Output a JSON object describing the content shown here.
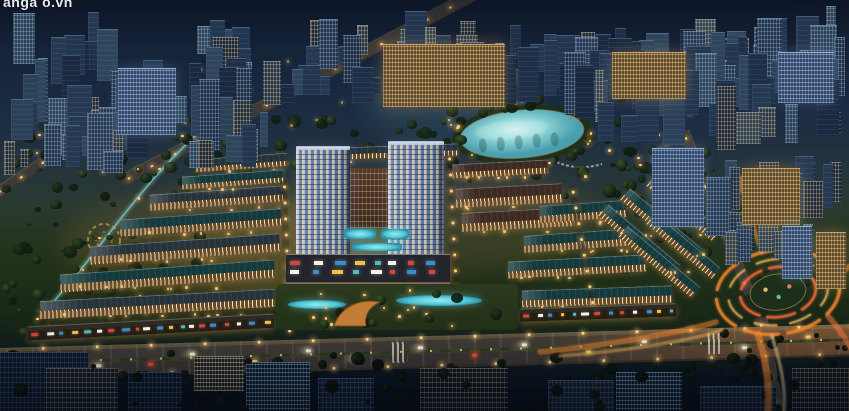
{
  "meta": {
    "width": 849,
    "height": 411,
    "description": "Night-time aerial 3D render of a mixed-use real-estate masterplan: twin residential towers on a retail podium with rooftop pools, fanned rows of lit shophouses, a glowing lagoon lake ringed by palms, landscaped parks, a main boulevard with traffic, and a light-trail roundabout, all surrounded by a dense city."
  },
  "watermark": {
    "text": "anga o.vn"
  },
  "palette": {
    "bldg": [
      "#1e2f47",
      "#253a52",
      "#2b4158",
      "#1a2940",
      "#223650",
      "#2e455c"
    ],
    "window_warm": "#ffcf7e",
    "window_cool": "#cfe2f2",
    "tree": [
      "#15240f",
      "#22351a",
      "#2f4520",
      "#3d5526"
    ],
    "tree_dark": [
      "#0a130c",
      "#0e1910",
      "#132015"
    ],
    "light_warm": "#ffd88f",
    "roof_teal": "#16393c",
    "roof_teal_l": "#1f4b4e",
    "roof_maroon": "#3c2a25",
    "roof_maroon_l": "#52362c",
    "roof_slate": "#26333b",
    "roof_slate_l": "#33434c",
    "lake_core": "#cfeeec",
    "lake_mid": "#8fd7d8",
    "lake_edge": "#4a9fae",
    "stream": "#58bfc2",
    "garden_ring": "#d8b36a",
    "trail": "#ff8c2e",
    "trail_soft": "#ffc05e",
    "trail_hot": "#ff6a3a",
    "pool": "#4ec6d6",
    "pool_light": "#9fe8ee",
    "feature": "#c27c38",
    "feature_dark": "#7e4c1e",
    "sign": [
      "#e33f35",
      "#f5f2ea",
      "#2f8fd8",
      "#f2c23e",
      "#44c1b7",
      "#f5f2ea",
      "#e33f35",
      "#2f8fd8"
    ],
    "fg": [
      "#0e1a2a",
      "#101d2e",
      "#0c1726",
      "#13202f"
    ]
  },
  "glows": [
    {
      "x": 220,
      "y": 245,
      "w": 320,
      "h": 110,
      "c": "rgba(255,170,80,0.10)"
    },
    {
      "x": 430,
      "y": 220,
      "w": 330,
      "h": 110,
      "c": "rgba(255,170,80,0.09)"
    },
    {
      "x": 300,
      "y": 255,
      "w": 260,
      "h": 90,
      "c": "rgba(255,190,100,0.12)"
    },
    {
      "x": 450,
      "y": 100,
      "w": 180,
      "h": 80,
      "c": "rgba(120,220,220,0.10)"
    }
  ],
  "city_regions": [
    {
      "x": 0,
      "y": 0,
      "w": 849,
      "h": 105,
      "count": 95,
      "minH": 14,
      "maxH": 55,
      "lit": 0.45
    },
    {
      "x": 0,
      "y": 55,
      "w": 270,
      "h": 115,
      "count": 34,
      "minH": 22,
      "maxH": 70,
      "lit": 0.5
    },
    {
      "x": 540,
      "y": 0,
      "w": 309,
      "h": 150,
      "count": 44,
      "minH": 18,
      "maxH": 65,
      "lit": 0.5
    },
    {
      "x": 700,
      "y": 120,
      "w": 149,
      "h": 160,
      "count": 24,
      "minH": 20,
      "maxH": 60,
      "lit": 0.55
    },
    {
      "x": 0,
      "y": 85,
      "w": 130,
      "h": 95,
      "count": 14,
      "minH": 16,
      "maxH": 45,
      "lit": 0.5
    }
  ],
  "landmarks": [
    {
      "x": 383,
      "y": 44,
      "w": 122,
      "h": 62,
      "kind": "warm"
    },
    {
      "x": 612,
      "y": 52,
      "w": 74,
      "h": 46,
      "kind": "warm"
    },
    {
      "x": 118,
      "y": 68,
      "w": 58,
      "h": 66,
      "kind": "cool"
    },
    {
      "x": 778,
      "y": 52,
      "w": 56,
      "h": 50,
      "kind": "cool"
    },
    {
      "x": 652,
      "y": 148,
      "w": 52,
      "h": 78,
      "kind": "cool"
    },
    {
      "x": 742,
      "y": 168,
      "w": 58,
      "h": 56,
      "kind": "warm"
    },
    {
      "x": 782,
      "y": 226,
      "w": 30,
      "h": 52,
      "kind": "cool"
    },
    {
      "x": 816,
      "y": 232,
      "w": 30,
      "h": 56,
      "kind": "warm"
    }
  ],
  "roads": {
    "boulevard": {
      "x": -20,
      "y": 336,
      "w": 900,
      "h": 28,
      "rot": -1.6
    },
    "diagonals": [
      {
        "cx": 312,
        "cy": 80,
        "len": 430,
        "wd": 13,
        "rot": -28
      },
      {
        "cx": 72,
        "cy": 142,
        "len": 190,
        "wd": 11,
        "rot": -34
      },
      {
        "cx": 716,
        "cy": 212,
        "len": 175,
        "wd": 11,
        "rot": 68
      },
      {
        "cx": 770,
        "cy": 372,
        "len": 110,
        "wd": 14,
        "rot": 80
      }
    ],
    "inner_streets": [
      {
        "cx": 286,
        "cy": 255,
        "len": 150,
        "wd": 7,
        "rot": 88
      },
      {
        "cx": 452,
        "cy": 222,
        "len": 140,
        "wd": 7,
        "rot": 87
      },
      {
        "cx": 582,
        "cy": 245,
        "len": 120,
        "wd": 6,
        "rot": 80
      }
    ],
    "crosswalks": [
      {
        "x": 392
      },
      {
        "x": 708
      }
    ],
    "streetlight_step": 54
  },
  "cars": [
    {
      "x": 58,
      "lane": -1,
      "c": "w"
    },
    {
      "x": 96,
      "lane": 1,
      "c": "w"
    },
    {
      "x": 148,
      "lane": 1,
      "c": "r"
    },
    {
      "x": 190,
      "lane": -1,
      "c": "w"
    },
    {
      "x": 252,
      "lane": 1,
      "c": "y"
    },
    {
      "x": 306,
      "lane": -1,
      "c": "w"
    },
    {
      "x": 352,
      "lane": 1,
      "c": "w"
    },
    {
      "x": 418,
      "lane": -1,
      "c": "w"
    },
    {
      "x": 472,
      "lane": 1,
      "c": "r"
    },
    {
      "x": 522,
      "lane": -1,
      "c": "w"
    },
    {
      "x": 586,
      "lane": 1,
      "c": "y"
    },
    {
      "x": 642,
      "lane": -1,
      "c": "w"
    },
    {
      "x": 742,
      "lane": 1,
      "c": "w"
    },
    {
      "x": 806,
      "lane": -1,
      "c": "y"
    }
  ],
  "lake": {
    "cx": 522,
    "cy": 134,
    "rx": 62,
    "ry": 24,
    "rot": -5,
    "palms": 18,
    "rim_lights": 8
  },
  "stream_path": "M 218,116 C 170,155 135,200 100,245 C 80,272 55,300 36,322",
  "pergola_path": "M 552,160 Q 576,172 602,164",
  "garden": {
    "cx": 104,
    "cy": 240,
    "r1": 16,
    "r2": 8
  },
  "rows": [
    {
      "x": 150,
      "y": 190,
      "w": 135,
      "h": 15,
      "rot": -4,
      "roof": "slate"
    },
    {
      "x": 120,
      "y": 214,
      "w": 162,
      "h": 16,
      "rot": -4,
      "roof": "teal"
    },
    {
      "x": 90,
      "y": 240,
      "w": 190,
      "h": 17,
      "rot": -4,
      "roof": "slate"
    },
    {
      "x": 60,
      "y": 267,
      "w": 215,
      "h": 17,
      "rot": -4,
      "roof": "teal"
    },
    {
      "x": 40,
      "y": 295,
      "w": 235,
      "h": 17,
      "rot": -3,
      "roof": "slate"
    },
    {
      "x": 28,
      "y": 320,
      "w": 246,
      "h": 13,
      "rot": -3,
      "roof": "slate",
      "retail": true
    },
    {
      "x": 196,
      "y": 156,
      "w": 92,
      "h": 12,
      "rot": -4,
      "roof": "slate"
    },
    {
      "x": 182,
      "y": 173,
      "w": 102,
      "h": 12,
      "rot": -4,
      "roof": "teal"
    },
    {
      "x": 308,
      "y": 146,
      "w": 150,
      "h": 11,
      "rot": -2,
      "roof": "slate"
    },
    {
      "x": 452,
      "y": 162,
      "w": 96,
      "h": 13,
      "rot": -3,
      "roof": "maroon"
    },
    {
      "x": 456,
      "y": 186,
      "w": 106,
      "h": 18,
      "rot": -3,
      "roof": "maroon"
    },
    {
      "x": 462,
      "y": 210,
      "w": 112,
      "h": 18,
      "rot": -3,
      "roof": "maroon"
    },
    {
      "x": 540,
      "y": 203,
      "w": 86,
      "h": 16,
      "rot": -4,
      "roof": "teal"
    },
    {
      "x": 524,
      "y": 232,
      "w": 112,
      "h": 16,
      "rot": -4,
      "roof": "teal"
    },
    {
      "x": 508,
      "y": 258,
      "w": 138,
      "h": 16,
      "rot": -3,
      "roof": "teal"
    },
    {
      "x": 522,
      "y": 288,
      "w": 150,
      "h": 16,
      "rot": -2,
      "roof": "teal"
    },
    {
      "x": 520,
      "y": 306,
      "w": 156,
      "h": 12,
      "rot": -2,
      "roof": "slate",
      "retail": true
    },
    {
      "x": 592,
      "y": 233,
      "w": 95,
      "h": 14,
      "rot": 40,
      "roof": "teal"
    },
    {
      "x": 614,
      "y": 217,
      "w": 95,
      "h": 14,
      "rot": 40,
      "roof": "teal"
    },
    {
      "x": 641,
      "y": 201,
      "w": 85,
      "h": 13,
      "rot": 40,
      "roof": "teal"
    },
    {
      "x": 612,
      "y": 255,
      "w": 95,
      "h": 13,
      "rot": 40,
      "roof": "teal"
    },
    {
      "x": 641,
      "y": 239,
      "w": 85,
      "h": 13,
      "rot": 40,
      "roof": "teal"
    }
  ],
  "dev": {
    "towers": [
      {
        "x": 296,
        "y": 147,
        "w": 54,
        "h": 112
      },
      {
        "x": 388,
        "y": 142,
        "w": 56,
        "h": 117
      }
    ],
    "courtyard": {
      "x": 326,
      "y": 168,
      "w": 88,
      "h": 58
    },
    "pools": [
      {
        "x": 344,
        "y": 229,
        "w": 32,
        "h": 10
      },
      {
        "x": 381,
        "y": 229,
        "w": 28,
        "h": 10
      },
      {
        "x": 352,
        "y": 243,
        "w": 50,
        "h": 8
      }
    ],
    "podium": {
      "x": 286,
      "y": 254,
      "w": 164,
      "h": 32
    },
    "amenity": {
      "x": 276,
      "y": 284,
      "w": 242,
      "h": 46
    },
    "ponds": [
      {
        "x": 288,
        "y": 300,
        "w": 58,
        "h": 9
      },
      {
        "x": 396,
        "y": 295,
        "w": 86,
        "h": 11
      }
    ],
    "feature": {
      "x": 330,
      "y": 294,
      "w": 58,
      "h": 34
    }
  },
  "roundabout": {
    "cx": 778,
    "cy": 292,
    "rot": -8,
    "rings": [
      [
        62,
        42
      ],
      [
        50,
        33
      ],
      [
        38,
        25
      ]
    ],
    "island": [
      28,
      18
    ],
    "island_dots": [
      "#ffd57e",
      "#7ad1c0",
      "#ff8c5e"
    ]
  },
  "trails": [
    {
      "d": "M 540,352 C 620,344 690,330 716,322",
      "w": 5,
      "c": "#ff8c2e",
      "o": 0.5
    },
    {
      "d": "M 560,356 C 640,350 700,338 722,330",
      "w": 3,
      "c": "#ffc05e",
      "o": 0.45
    },
    {
      "d": "M 758,334 C 766,360 770,385 768,411",
      "w": 6,
      "c": "#ff8c2e",
      "o": 0.6
    },
    {
      "d": "M 772,336 C 780,362 786,386 784,411",
      "w": 3,
      "c": "#ffe0a0",
      "o": 0.5
    },
    {
      "d": "M 762,252 C 752,225 744,200 740,178",
      "w": 4,
      "c": "#ff9a3e",
      "o": 0.5
    },
    {
      "d": "M 828,316 C 840,330 848,342 849,346",
      "w": 5,
      "c": "#ff7a3e",
      "o": 0.55
    },
    {
      "d": "M 836,278 C 844,272 848,268 849,266",
      "w": 4,
      "c": "#ff8c2e",
      "o": 0.5
    }
  ],
  "foreground": [
    {
      "x": -8,
      "y": 352,
      "w": 96,
      "h": 60,
      "lit": "cool"
    },
    {
      "x": 46,
      "y": 368,
      "w": 72,
      "h": 44,
      "lit": "warm"
    },
    {
      "x": 128,
      "y": 372,
      "w": 54,
      "h": 40,
      "lit": "cool"
    },
    {
      "x": 194,
      "y": 356,
      "w": 50,
      "h": 34,
      "lit": "warm2"
    },
    {
      "x": 246,
      "y": 362,
      "w": 64,
      "h": 50,
      "lit": "cool2"
    },
    {
      "x": 318,
      "y": 378,
      "w": 56,
      "h": 34,
      "lit": "cool"
    },
    {
      "x": 420,
      "y": 368,
      "w": 88,
      "h": 44,
      "lit": "warm"
    },
    {
      "x": 548,
      "y": 380,
      "w": 66,
      "h": 32,
      "lit": "cool"
    },
    {
      "x": 616,
      "y": 372,
      "w": 66,
      "h": 40,
      "lit": "cool2"
    },
    {
      "x": 700,
      "y": 386,
      "w": 76,
      "h": 26,
      "lit": "cool"
    },
    {
      "x": 792,
      "y": 368,
      "w": 57,
      "h": 44,
      "lit": "warm"
    }
  ],
  "park_regions": [
    {
      "x": 0,
      "y": 116,
      "w": 195,
      "h": 215,
      "count": 85,
      "dark": false
    },
    {
      "x": 148,
      "y": 112,
      "w": 310,
      "h": 52,
      "count": 40,
      "dark": false
    },
    {
      "x": 436,
      "y": 86,
      "w": 268,
      "h": 112,
      "count": 62,
      "dark": false,
      "avoidLake": true
    },
    {
      "x": 618,
      "y": 138,
      "w": 124,
      "h": 132,
      "count": 40,
      "dark": false
    },
    {
      "x": 742,
      "y": 240,
      "w": 70,
      "h": 70,
      "count": 10,
      "dark": false
    },
    {
      "x": 0,
      "y": 350,
      "w": 849,
      "h": 61,
      "count": 64,
      "dark": true
    },
    {
      "x": 688,
      "y": 328,
      "w": 161,
      "h": 83,
      "count": 22,
      "dark": true
    }
  ],
  "fg_trees": {
    "x": 0,
    "y": 356,
    "w": 849,
    "h": 55,
    "count": 22
  },
  "light_regions": [
    {
      "x": 18,
      "y": 128,
      "w": 180,
      "h": 195,
      "count": 24
    },
    {
      "x": 440,
      "y": 95,
      "w": 250,
      "h": 100,
      "count": 20,
      "avoidLake": true
    },
    {
      "x": 624,
      "y": 145,
      "w": 104,
      "h": 115,
      "count": 12
    },
    {
      "x": 80,
      "y": 55,
      "w": 700,
      "h": 70,
      "count": 22,
      "faint": true
    }
  ]
}
